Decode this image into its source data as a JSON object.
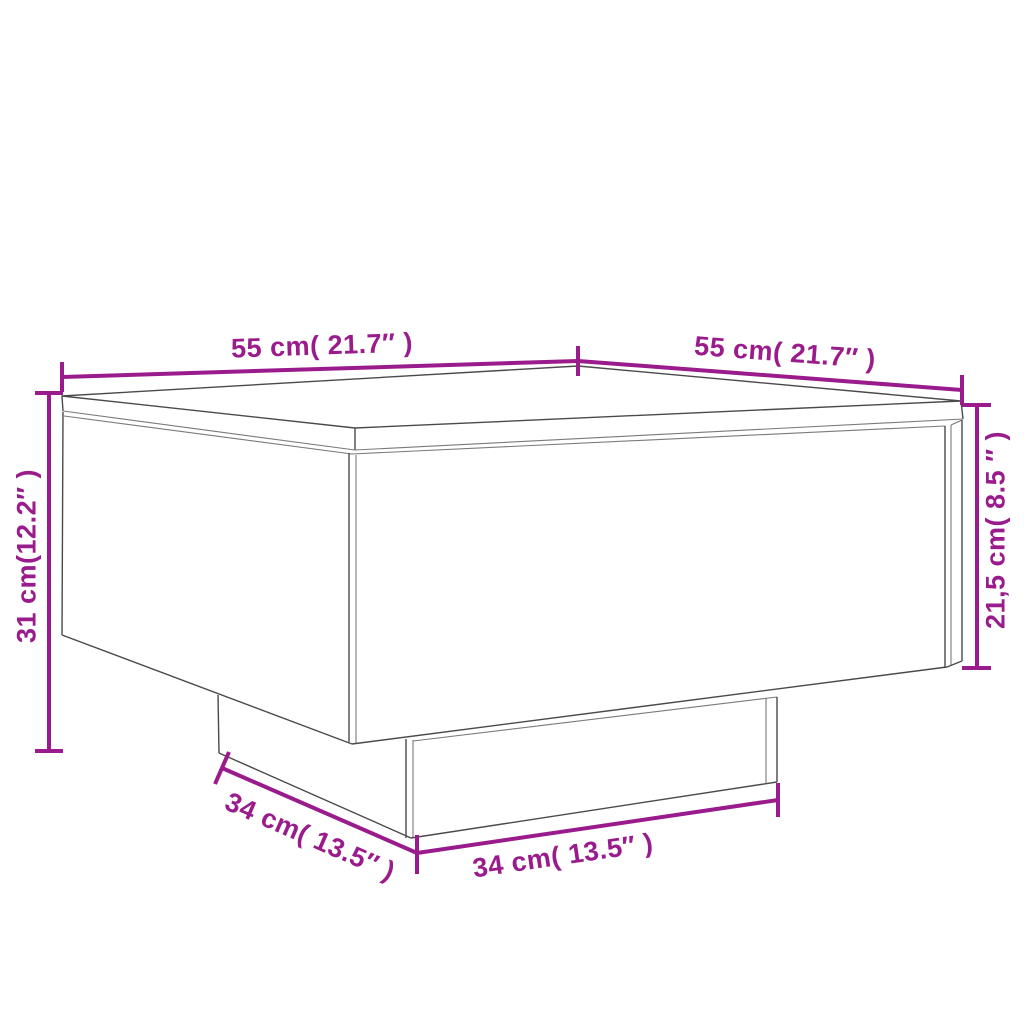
{
  "page": {
    "width": 1024,
    "height": 1024,
    "background": "#ffffff"
  },
  "colors": {
    "dimension": "#9A1B8C",
    "drawing_line": "#4a4a4a",
    "drawing_line_light": "#7a7a7a"
  },
  "drawing": {
    "subject": "coffee table with recessed plinth base, 3D perspective line drawing"
  },
  "labels": {
    "top_width": "55 cm( 21.7″ )",
    "top_depth": "55 cm( 21.7″ )",
    "total_height": "31 cm(12.2″ )",
    "body_height": "21,5 cm( 8.5 ″ )",
    "base_depth": "34 cm( 13.5″ )",
    "base_width": "34 cm( 13.5″ )"
  }
}
